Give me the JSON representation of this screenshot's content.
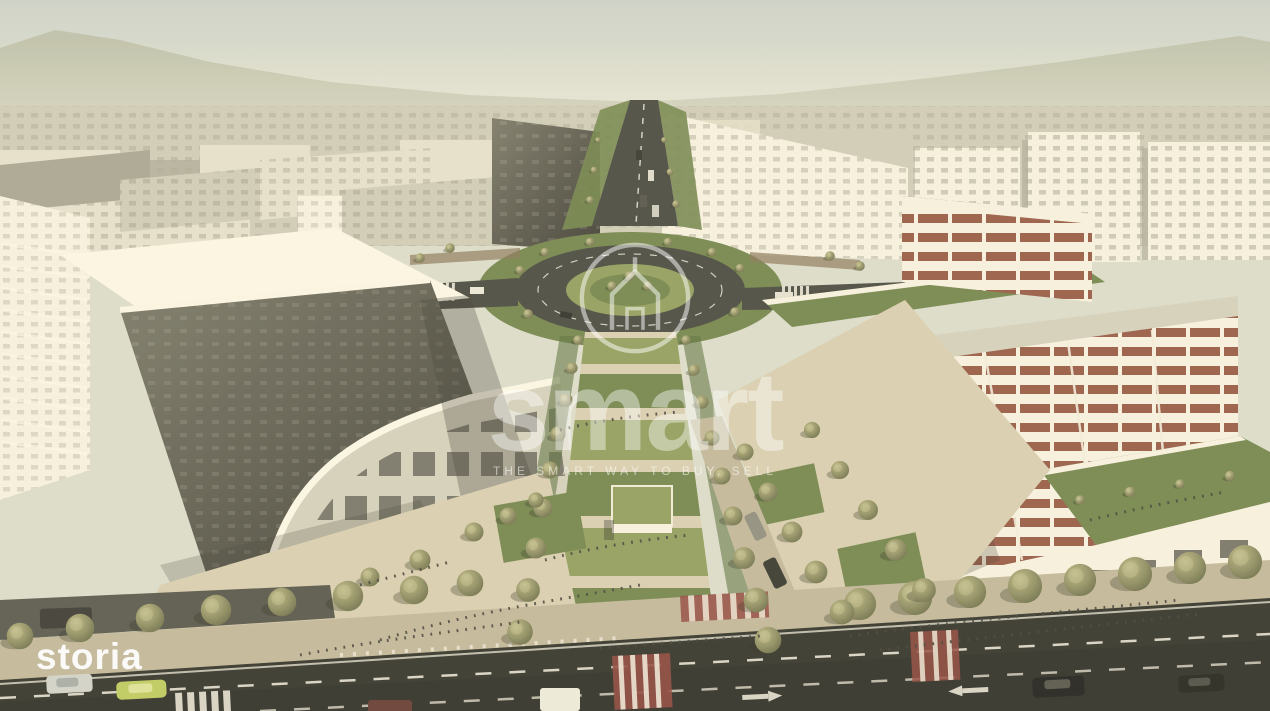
{
  "watermarks": {
    "storia": {
      "text": "storia",
      "color": "#ffffff"
    },
    "smart": {
      "wordmark": "smart",
      "tagline": "THE SMART WAY TO BUY, SELL",
      "logo_icon": "house-in-circle-icon"
    }
  },
  "palette": {
    "sky-top": "#c3ccc6",
    "sky-haze": "#dcdcca",
    "mountain": "#b2b79d",
    "city-light": "#ddd9c5",
    "city-mid": "#c9c5b1",
    "city-shadow": "#a5a28e",
    "win-dark": "#75735f",
    "bwhite": "#ece9d9",
    "bwhite-shade": "#cdcab6",
    "facade-dark": "#6b695a",
    "facade-darker": "#44443a",
    "brick": "#a0553f",
    "lawn-bright": "#8c9c51",
    "lawn-mid": "#6f8643",
    "lawn-dark": "#587338",
    "tree-light": "#b3b075",
    "tree-mid": "#8b8c58",
    "tree-dark": "#5f6339",
    "asphalt": "#35352c",
    "asphalt2": "#4a4a40",
    "road-line": "#eae8db",
    "plaza": "#d2c8a8",
    "plaza-shade": "#bdb393",
    "cross-red": "#9c4338"
  }
}
